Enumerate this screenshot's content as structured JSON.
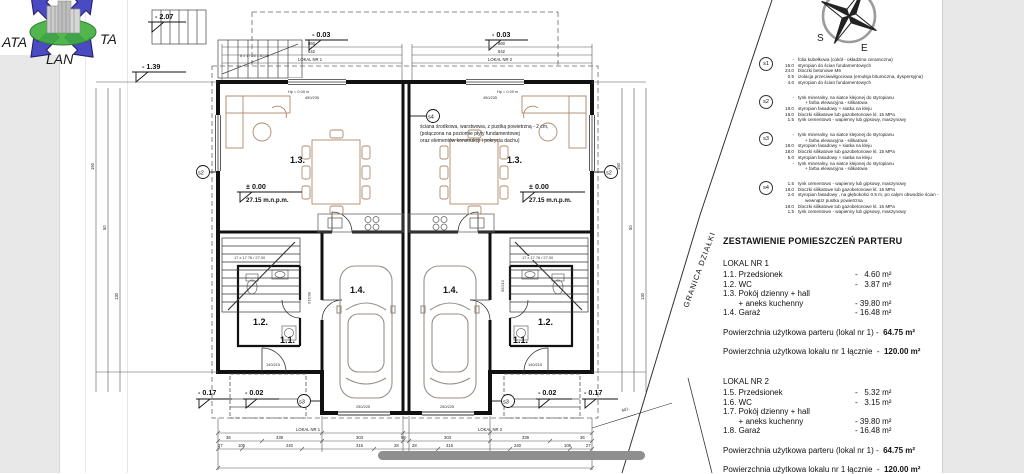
{
  "logo": {
    "ata": "ATA",
    "ta": "TA",
    "lan": "LAN"
  },
  "compass": {
    "south": "S",
    "east": "E"
  },
  "plan": {
    "granica": "GRANICA DZIAŁKI",
    "note1": "ściana środkowa, warstwowa, z pustką powietrzną - 2 cm,",
    "note2": "(połączona na poziomie płyty fundamentowej",
    "note3": "oraz elementów konstrukcji i pokrycia dachu)",
    "lokal1": "LOKAL NR 1",
    "lokal2": "LOKAL NR 2",
    "room11": "1.1.",
    "room12": "1.2.",
    "room13": "1.3.",
    "room14": "1.4.",
    "lvl207": "-  2.07",
    "lvl139": "-  1.39",
    "lvl003": "-  0.03",
    "lvl000": "±  0.00",
    "alt": "27.15 m.n.p.m.",
    "lvl017": "-  0.17",
    "lvl002": "-  0.02",
    "hp": "Hp = 0.00 m",
    "stairs_ext": "8 x 17.00 / 30.00",
    "stairs_int": "17 x 17.76 / 27.00",
    "win": "450/235",
    "gdoor": "250/225",
    "edoor": "140/215",
    "idoor": "90/210",
    "s2": "s2",
    "s3": "s3",
    "s4": "s4",
    "d860": "860",
    "d642": "642",
    "d401": "401",
    "d194": "194",
    "b1": [
      "36",
      "339",
      "303",
      "98",
      "303",
      "339",
      "36"
    ],
    "b2": [
      "27",
      "105",
      "240",
      "315",
      "28",
      "28",
      "315",
      "240",
      "105",
      "27"
    ],
    "side": [
      "150",
      "50",
      "130"
    ]
  },
  "legend": {
    "s1": {
      "id": "s1",
      "lines": [
        {
          "t": "-",
          "d": "folia kubełkowa (cokół - okładzina ceramiczna)"
        },
        {
          "t": "15.0",
          "d": "styropian do ścian fundamentowych"
        },
        {
          "t": "24.0",
          "d": "bloczki betonowe M6"
        },
        {
          "t": "0.5",
          "d": "izolacja przeciwwilgociowa (emulsja bitumiczna, dyspersyjna)"
        },
        {
          "t": "4.0",
          "d": "styropian do ścian fundamentowych"
        }
      ]
    },
    "s2": {
      "id": "s2",
      "lines": [
        {
          "t": "-",
          "d": "tynk mineralny, na siatce klejonej do styropianu"
        },
        {
          "t": "",
          "d": "+ farba elewacyjna - silikatowa"
        },
        {
          "t": "18.0",
          "d": "styropian fasadowy + siatka na kleju"
        },
        {
          "t": "18.0",
          "d": "bloczki silikatowe lub gazobetonowe kl. 15 MPa"
        },
        {
          "t": "1.5",
          "d": "tynk cementowo - wapienny lub gipsowy, maszynowy"
        }
      ]
    },
    "s3": {
      "id": "s3",
      "lines": [
        {
          "t": "-",
          "d": "tynk mineralny, na siatce klejonej do styropianu"
        },
        {
          "t": "",
          "d": "+ farba elewacyjna - silikatowa"
        },
        {
          "t": "18.0",
          "d": "styropian fasadowy + siatka na kleju"
        },
        {
          "t": "18.0",
          "d": "bloczki silikatowe lub gazobetonowe kl. 15 MPa"
        },
        {
          "t": "5.0",
          "d": "styropian fasadowy + siatka na kleju"
        },
        {
          "t": "-",
          "d": "tynk mineralny, na siatce klejonej do styropianu"
        },
        {
          "t": "",
          "d": "+ farba elewacyjna - silikatowa"
        }
      ]
    },
    "s4": {
      "id": "s4",
      "lines": [
        {
          "t": "1.5",
          "d": "tynk cementowo - wapienny lub gipsowy, maszynowy"
        },
        {
          "t": "18.0",
          "d": "bloczki silikatowe lub gazobetonowe kl. 15 MPa"
        },
        {
          "t": "2.0",
          "d": "styropian fasadowy , na głębokości 0.5 m, po całym obwodzie ścian -"
        },
        {
          "t": "",
          "d": "wewnątrz pustka powietrzna"
        },
        {
          "t": "18.0",
          "d": "bloczki silikatowe lub gazobetonowe kl. 15 MPa"
        },
        {
          "t": "1.5",
          "d": "tynk cementowo - wapienny lub gipsowy, maszynowy"
        }
      ]
    }
  },
  "schedule": {
    "title": "ZESTAWIENIE POMIESZCZEŃ PARTERU",
    "lokal1": {
      "header": "LOKAL NR 1",
      "rows": [
        {
          "label": "1.1. Przedsionek",
          "value": "-   4.60 m²"
        },
        {
          "label": "1.2. WC",
          "value": "-   3.87 m²"
        },
        {
          "label": "1.3. Pokój dzienny + hall",
          "value": ""
        },
        {
          "label": "       + aneks kuchenny",
          "value": "- 39.80 m²"
        },
        {
          "label": "1.4. Garaż",
          "value": "- 16.48 m²"
        }
      ],
      "total1_label": "Powierzchnia użytkowa parteru (lokal nr 1) -  ",
      "total1_value": "64.75 m²",
      "total2_label": "Powierzchnia użytkowa lokalu nr 1 łącznie  -  ",
      "total2_value": "120.00 m²"
    },
    "lokal2": {
      "header": "LOKAL NR 2",
      "rows": [
        {
          "label": "1.5. Przedsionek",
          "value": "-   5.32 m²"
        },
        {
          "label": "1.6. WC",
          "value": "-   3.15 m²"
        },
        {
          "label": "1.7. Pokój dzienny + hall",
          "value": ""
        },
        {
          "label": "       + aneks kuchenny",
          "value": "- 39.80 m²"
        },
        {
          "label": "1.8. Garaż",
          "value": "- 16.48 m²"
        }
      ],
      "total1_label": "Powierzchnia użytkowa parteru (lokal nr 1) -  ",
      "total1_value": "64.75 m²",
      "total2_label": "Powierzchnia użytkowa lokalu nr 1 łącznie  -  ",
      "total2_value": "120.00 m²"
    }
  }
}
